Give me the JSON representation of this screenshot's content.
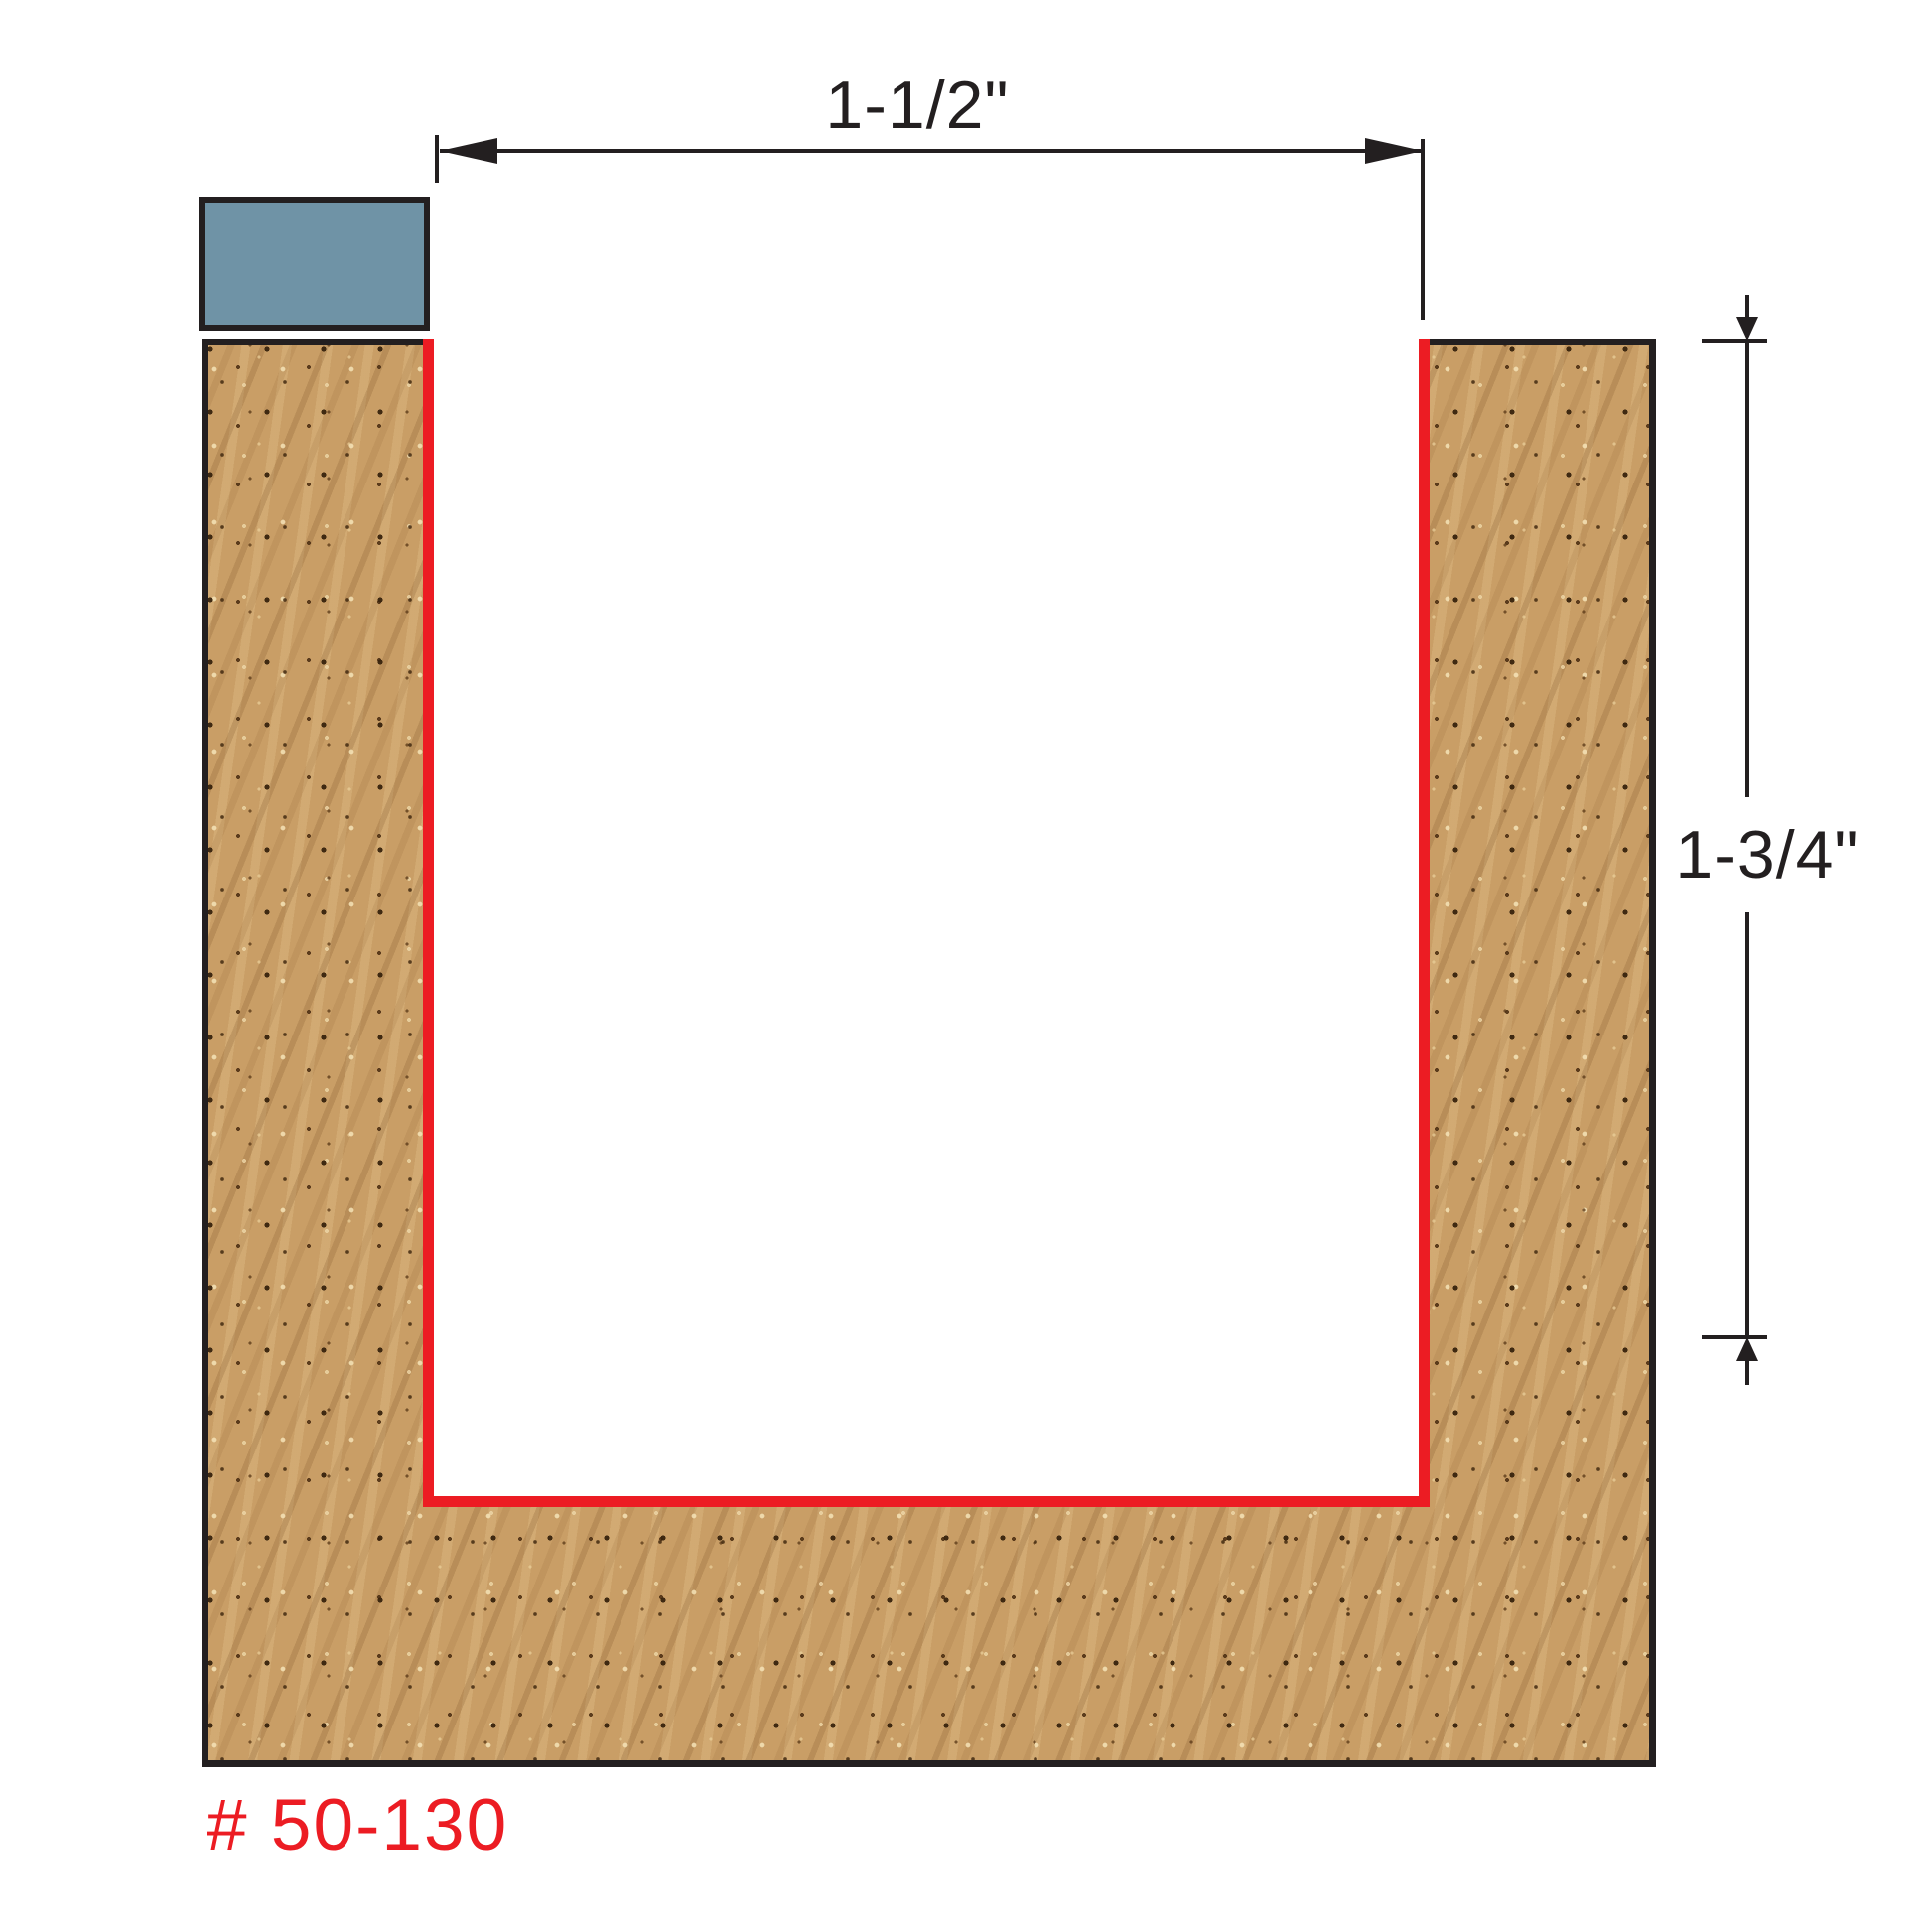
{
  "diagram": {
    "part_number": "# 50-130",
    "dimensions": {
      "width": {
        "label": "1-1/2\""
      },
      "depth": {
        "label": "1-3/4\""
      }
    },
    "colors": {
      "wood_base": "#c99e66",
      "outline_red": "#ec1c23",
      "cutter_blue": "#6f93a6",
      "line_black": "#231f20",
      "background": "#ffffff"
    }
  }
}
